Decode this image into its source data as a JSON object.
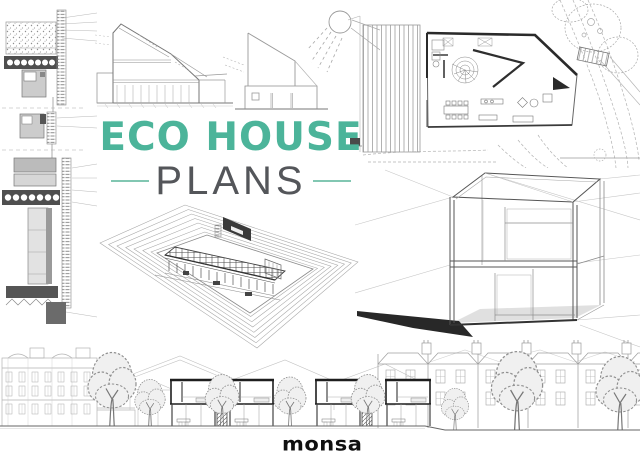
{
  "cover": {
    "title": {
      "line1": "ECO HOUSE",
      "line2": "PLANS"
    },
    "publisher": {
      "logo_text": "monsa"
    },
    "colors": {
      "title_teal": "#4CB49A",
      "rule_teal": "#82C7B2",
      "subtitle_gray": "#54565A",
      "logo_black": "#101010",
      "background": "#FFFFFF",
      "ink_dark": "#2B2B2B",
      "ink_mid": "#8A8A8A",
      "ink_light": "#BDBDBD"
    },
    "drawings": [
      {
        "name": "construction-detail-sections",
        "position": "left-column"
      },
      {
        "name": "house-cross-section-elevation",
        "position": "top-center-left"
      },
      {
        "name": "house-elevation-roof-sail",
        "position": "top-center-right"
      },
      {
        "name": "sun-sketch",
        "position": "top-center"
      },
      {
        "name": "site-floor-plan",
        "position": "top-right"
      },
      {
        "name": "axonometric-terraced-house",
        "position": "center"
      },
      {
        "name": "wireframe-cube-house",
        "position": "center-right"
      },
      {
        "name": "street-elevation-strip",
        "position": "bottom"
      }
    ]
  }
}
